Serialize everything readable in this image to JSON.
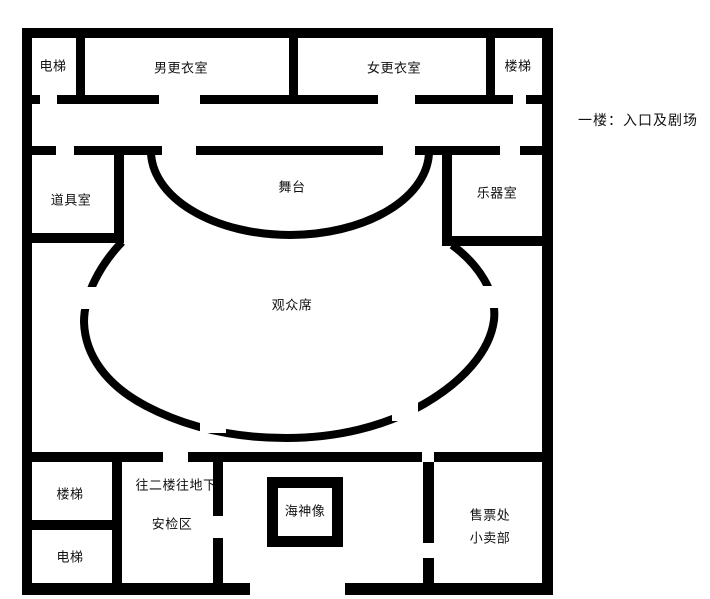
{
  "floor_title": "一楼：入口及剧场",
  "colors": {
    "wall": "#000000",
    "background": "#ffffff",
    "text": "#111111"
  },
  "rooms": [
    {
      "id": "elevator-top",
      "label": "电梯",
      "x": 53,
      "y": 65
    },
    {
      "id": "mens-changing-room",
      "label": "男更衣室",
      "x": 181,
      "y": 67
    },
    {
      "id": "womens-changing-room",
      "label": "女更衣室",
      "x": 394,
      "y": 67
    },
    {
      "id": "stairs-top",
      "label": "楼梯",
      "x": 518,
      "y": 65
    },
    {
      "id": "props-room",
      "label": "道具室",
      "x": 71,
      "y": 199
    },
    {
      "id": "stage",
      "label": "舞台",
      "x": 292,
      "y": 186
    },
    {
      "id": "instrument-room",
      "label": "乐器室",
      "x": 497,
      "y": 192
    },
    {
      "id": "audience-seating",
      "label": "观众席",
      "x": 292,
      "y": 304
    },
    {
      "id": "stairs-bottom",
      "label": "楼梯",
      "x": 70,
      "y": 493
    },
    {
      "id": "elevator-bottom",
      "label": "电梯",
      "x": 70,
      "y": 556
    },
    {
      "id": "to-second-floor-basement",
      "label": "往二楼往地下",
      "x": 176,
      "y": 484
    },
    {
      "id": "security-check-area",
      "label": "安检区",
      "x": 172,
      "y": 523
    },
    {
      "id": "poseidon-statue",
      "label": "海神像",
      "x": 305,
      "y": 510
    },
    {
      "id": "ticket-office",
      "label": "售票处",
      "x": 490,
      "y": 514
    },
    {
      "id": "kiosk",
      "label": "小卖部",
      "x": 490,
      "y": 537
    }
  ]
}
